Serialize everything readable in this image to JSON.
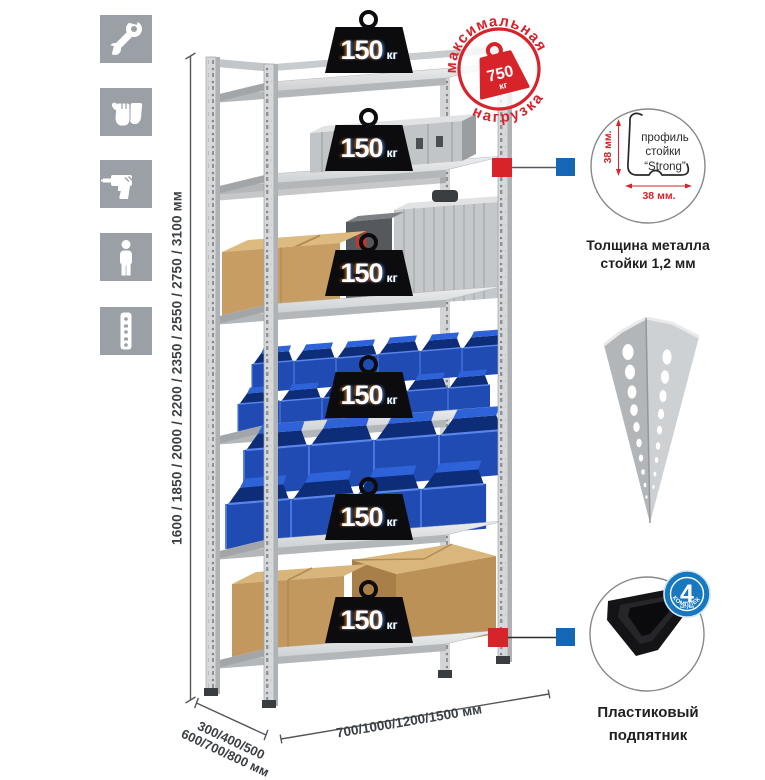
{
  "colors": {
    "accent_red": "#d7232a",
    "accent_blue": "#1566b4",
    "badge_blue": "#1778bf",
    "bin_blue": "#1f4bb2",
    "metal_gray": "#d6d8da",
    "icon_gray": "#9aa0a5"
  },
  "sidebar_icons": [
    {
      "name": "wrench"
    },
    {
      "name": "gloves"
    },
    {
      "name": "drill"
    },
    {
      "name": "person"
    },
    {
      "name": "perforated-profile"
    }
  ],
  "rack": {
    "shelf_count": 6,
    "shelf_weights": [
      {
        "value": "150",
        "unit": "кг"
      },
      {
        "value": "150",
        "unit": "кг"
      },
      {
        "value": "150",
        "unit": "кг"
      },
      {
        "value": "150",
        "unit": "кг"
      },
      {
        "value": "150",
        "unit": "кг"
      },
      {
        "value": "150",
        "unit": "кг"
      }
    ]
  },
  "max_load": {
    "arc_top": "максимальная",
    "arc_bottom": "нагрузка",
    "value": "750",
    "unit": "кг"
  },
  "dimensions": {
    "height": "1600 / 1850 / 2000 / 2200 / 2350 / 2550 / 2750 / 3100 мм",
    "depth_line1": "300/400/500",
    "depth_line2": "600/700/800 мм",
    "width": "700/1000/1200/1500 мм"
  },
  "profile_detail": {
    "line1": "профиль",
    "line2": "стойки",
    "line3": "“Strong”",
    "dim_v": "38 мм.",
    "dim_h": "38 мм.",
    "caption1": "Толщина металла",
    "caption2": "стойки 1,2 мм"
  },
  "foot_detail": {
    "badge_number": "4",
    "badge_sub": "штуки",
    "badge_arc": "в комплекте",
    "caption1": "Пластиковый",
    "caption2": "подпятник"
  }
}
